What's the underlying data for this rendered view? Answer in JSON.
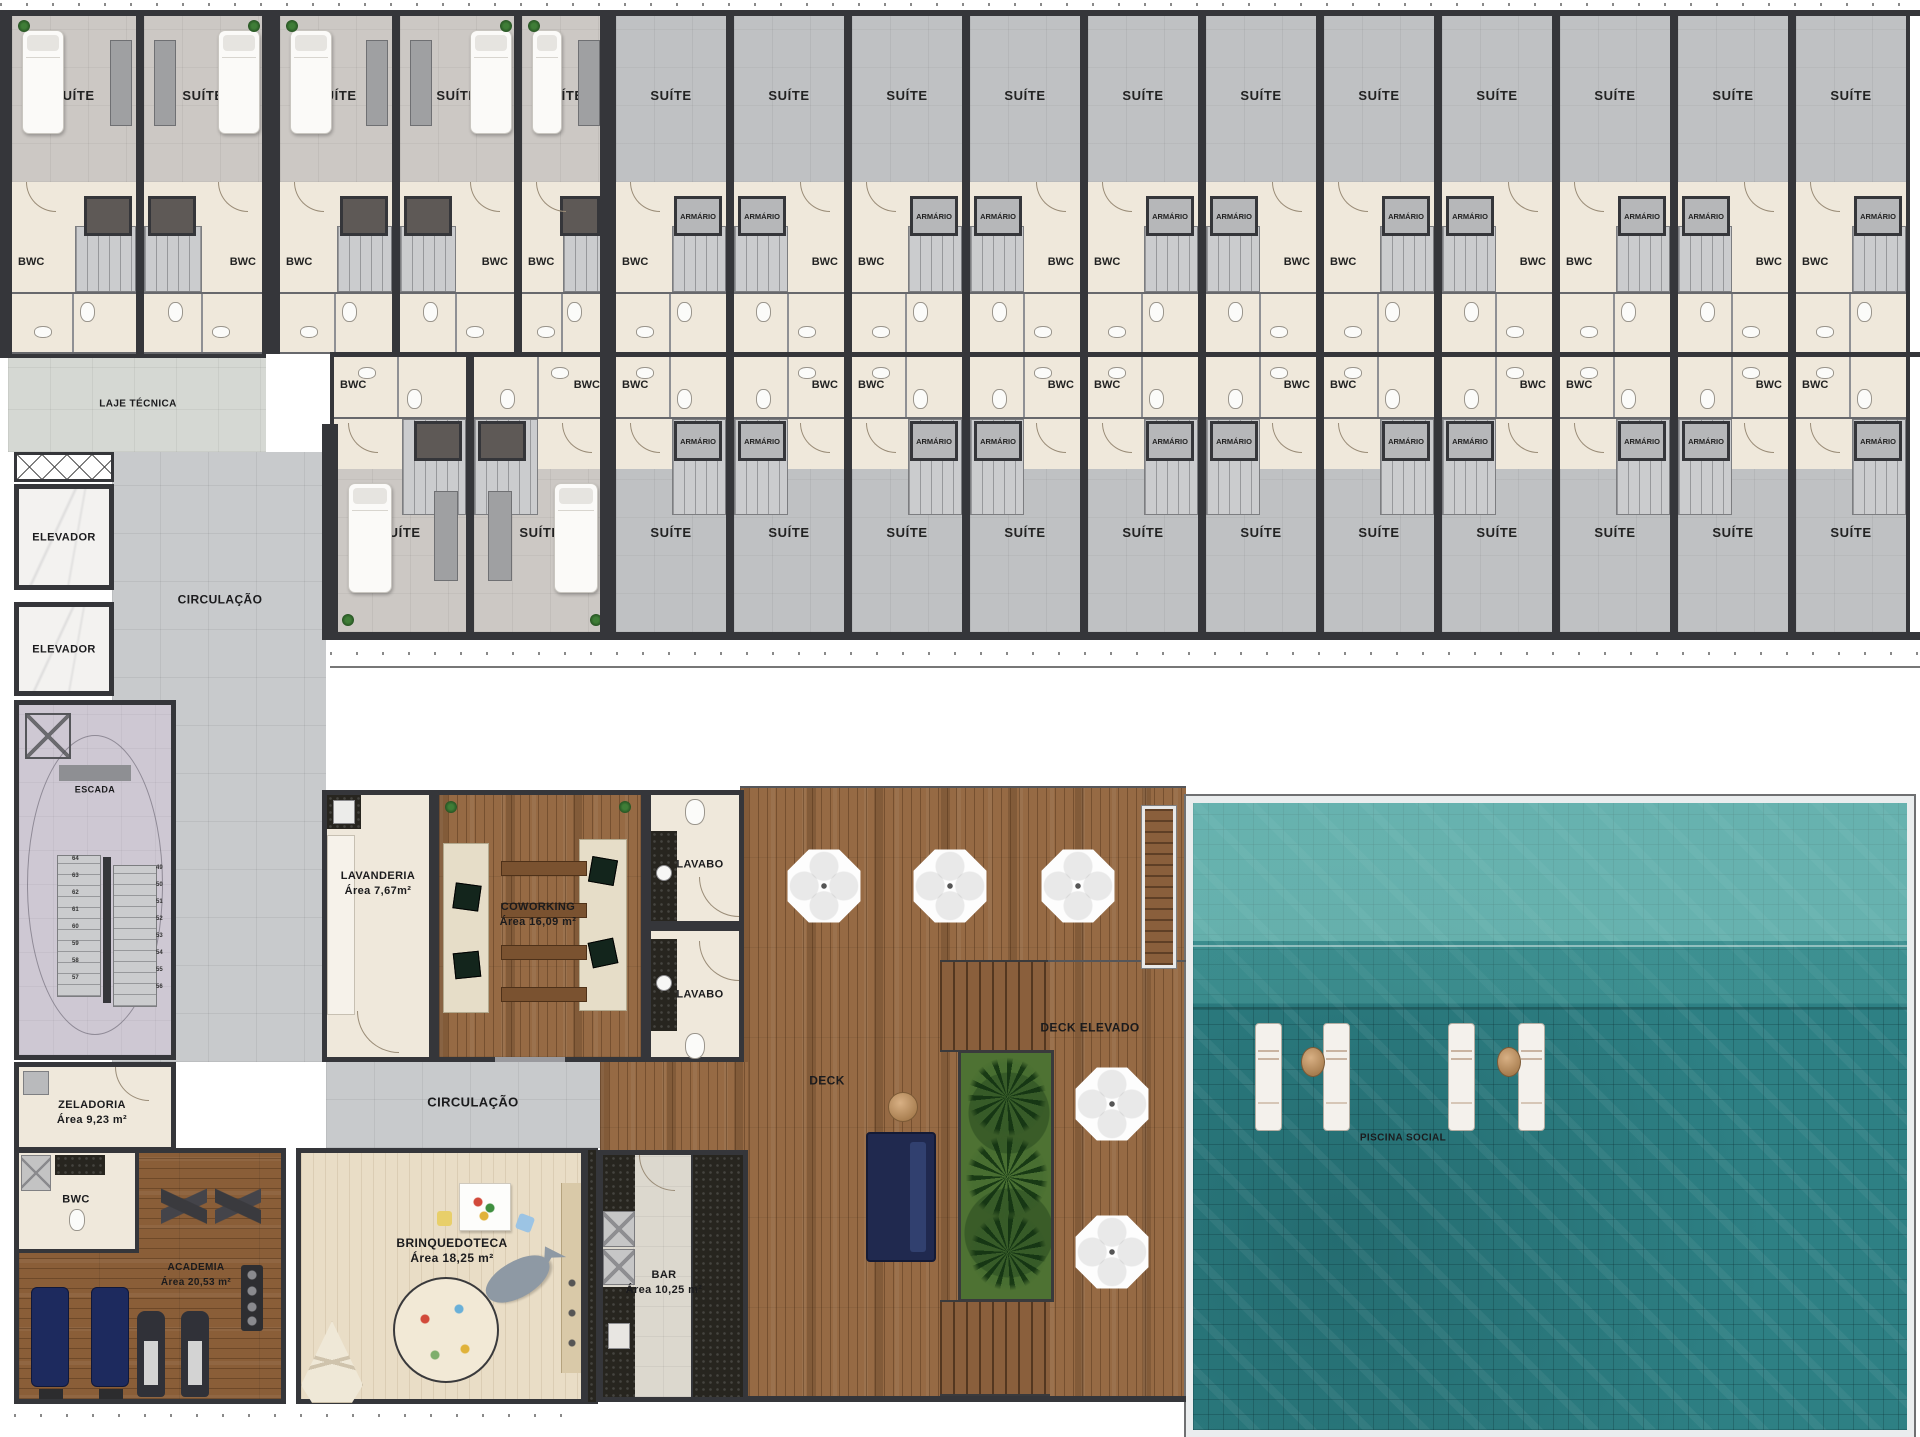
{
  "plan": {
    "width": 1920,
    "height": 1437
  },
  "strings": {
    "suite": "SUÍTE",
    "bwc": "BWC",
    "armario": "ARMÁRIO"
  },
  "rooms": [
    {
      "id": "laje-tecnica",
      "lines": [
        "LAJE TÉCNICA"
      ],
      "x": 138,
      "y": 404,
      "fs": 10
    },
    {
      "id": "elevador-1",
      "lines": [
        "ELEVADOR"
      ],
      "x": 64,
      "y": 538,
      "fs": 11
    },
    {
      "id": "elevador-2",
      "lines": [
        "ELEVADOR"
      ],
      "x": 64,
      "y": 650,
      "fs": 11
    },
    {
      "id": "circulacao-1",
      "lines": [
        "CIRCULAÇÃO"
      ],
      "x": 220,
      "y": 600,
      "fs": 12
    },
    {
      "id": "escada",
      "lines": [
        "ESCADA"
      ],
      "x": 95,
      "y": 790,
      "fs": 9
    },
    {
      "id": "zeladoria",
      "lines": [
        "ZELADORIA",
        "Área 9,23 m²"
      ],
      "x": 92,
      "y": 1113,
      "fs": 11
    },
    {
      "id": "bwc-academia",
      "lines": [
        "BWC"
      ],
      "x": 76,
      "y": 1200,
      "fs": 11
    },
    {
      "id": "academia",
      "lines": [
        "ACADEMIA",
        "Área 20,53 m²"
      ],
      "x": 196,
      "y": 1275,
      "fs": 10
    },
    {
      "id": "brinquedoteca",
      "lines": [
        "BRINQUEDOTECA",
        "Área 18,25 m²"
      ],
      "x": 452,
      "y": 1251,
      "fs": 12
    },
    {
      "id": "bar",
      "lines": [
        "BAR",
        "Área 10,25 m²"
      ],
      "x": 664,
      "y": 1283,
      "fs": 11
    },
    {
      "id": "lavanderia",
      "lines": [
        "LAVANDERIA",
        "Área 7,67m²"
      ],
      "x": 378,
      "y": 884,
      "fs": 11
    },
    {
      "id": "coworking",
      "lines": [
        "COWORKING",
        "Área 16,09 m²"
      ],
      "x": 538,
      "y": 915,
      "fs": 11
    },
    {
      "id": "lavabo-1",
      "lines": [
        "LAVABO"
      ],
      "x": 700,
      "y": 865,
      "fs": 11
    },
    {
      "id": "lavabo-2",
      "lines": [
        "LAVABO"
      ],
      "x": 700,
      "y": 995,
      "fs": 11
    },
    {
      "id": "circulacao-2",
      "lines": [
        "CIRCULAÇÃO"
      ],
      "x": 473,
      "y": 1102,
      "fs": 13
    },
    {
      "id": "deck",
      "lines": [
        "DECK"
      ],
      "x": 827,
      "y": 1081,
      "fs": 12
    },
    {
      "id": "deck-elevado",
      "lines": [
        "DECK ELEVADO"
      ],
      "x": 1090,
      "y": 1028,
      "fs": 12
    },
    {
      "id": "piscina-social",
      "lines": [
        "PISCINA SOCIAL"
      ],
      "x": 1403,
      "y": 1138,
      "fs": 10
    }
  ],
  "stair_numbers": {
    "left": [
      "64",
      "63",
      "62",
      "61",
      "60",
      "59",
      "58",
      "57"
    ],
    "right": [
      "49",
      "50",
      "51",
      "52",
      "53",
      "54",
      "55",
      "56"
    ]
  },
  "units": {
    "row1": [
      {
        "x": 8,
        "w": 132,
        "type": "furnished",
        "mirror": false
      },
      {
        "x": 140,
        "w": 126,
        "type": "furnished",
        "mirror": true
      },
      {
        "x": 276,
        "w": 120,
        "type": "furnished",
        "mirror": false
      },
      {
        "x": 396,
        "w": 122,
        "type": "furnished",
        "mirror": true
      },
      {
        "x": 518,
        "w": 90,
        "type": "furnished",
        "mirror": false
      },
      {
        "x": 612,
        "w": 118,
        "type": "gray",
        "mirror": false
      },
      {
        "x": 730,
        "w": 118,
        "type": "gray",
        "mirror": true
      },
      {
        "x": 848,
        "w": 118,
        "type": "gray",
        "mirror": false
      },
      {
        "x": 966,
        "w": 118,
        "type": "gray",
        "mirror": true
      },
      {
        "x": 1084,
        "w": 118,
        "type": "gray",
        "mirror": false
      },
      {
        "x": 1202,
        "w": 118,
        "type": "gray",
        "mirror": true
      },
      {
        "x": 1320,
        "w": 118,
        "type": "gray",
        "mirror": false
      },
      {
        "x": 1438,
        "w": 118,
        "type": "gray",
        "mirror": true
      },
      {
        "x": 1556,
        "w": 118,
        "type": "gray",
        "mirror": false
      },
      {
        "x": 1674,
        "w": 118,
        "type": "gray",
        "mirror": true
      },
      {
        "x": 1792,
        "w": 118,
        "type": "gray",
        "mirror": false
      }
    ],
    "row2": [
      {
        "x": 330,
        "w": 140,
        "type": "furnished",
        "mirror": false
      },
      {
        "x": 470,
        "w": 140,
        "type": "furnished",
        "mirror": true
      },
      {
        "x": 612,
        "w": 118,
        "type": "gray",
        "mirror": false
      },
      {
        "x": 730,
        "w": 118,
        "type": "gray",
        "mirror": true
      },
      {
        "x": 848,
        "w": 118,
        "type": "gray",
        "mirror": false
      },
      {
        "x": 966,
        "w": 118,
        "type": "gray",
        "mirror": true
      },
      {
        "x": 1084,
        "w": 118,
        "type": "gray",
        "mirror": false
      },
      {
        "x": 1202,
        "w": 118,
        "type": "gray",
        "mirror": true
      },
      {
        "x": 1320,
        "w": 118,
        "type": "gray",
        "mirror": false
      },
      {
        "x": 1438,
        "w": 118,
        "type": "gray",
        "mirror": true
      },
      {
        "x": 1556,
        "w": 118,
        "type": "gray",
        "mirror": false
      },
      {
        "x": 1674,
        "w": 118,
        "type": "gray",
        "mirror": true
      },
      {
        "x": 1792,
        "w": 118,
        "type": "gray",
        "mirror": false
      }
    ]
  },
  "deck": {
    "umbrellas": [
      [
        824,
        886
      ],
      [
        950,
        886
      ],
      [
        1078,
        886
      ],
      [
        1112,
        1104
      ],
      [
        1112,
        1252
      ]
    ]
  },
  "pool": {
    "loungers": [
      [
        1255,
        1023
      ],
      [
        1323,
        1023
      ],
      [
        1448,
        1023
      ],
      [
        1518,
        1023
      ]
    ],
    "tables": [
      [
        1301,
        1047
      ],
      [
        1497,
        1047
      ]
    ]
  },
  "colors": {
    "wall": "#35363a",
    "pool": "#2e8084",
    "wood": "#966a44",
    "bath": "#efe8db",
    "navy": "#20294f"
  }
}
